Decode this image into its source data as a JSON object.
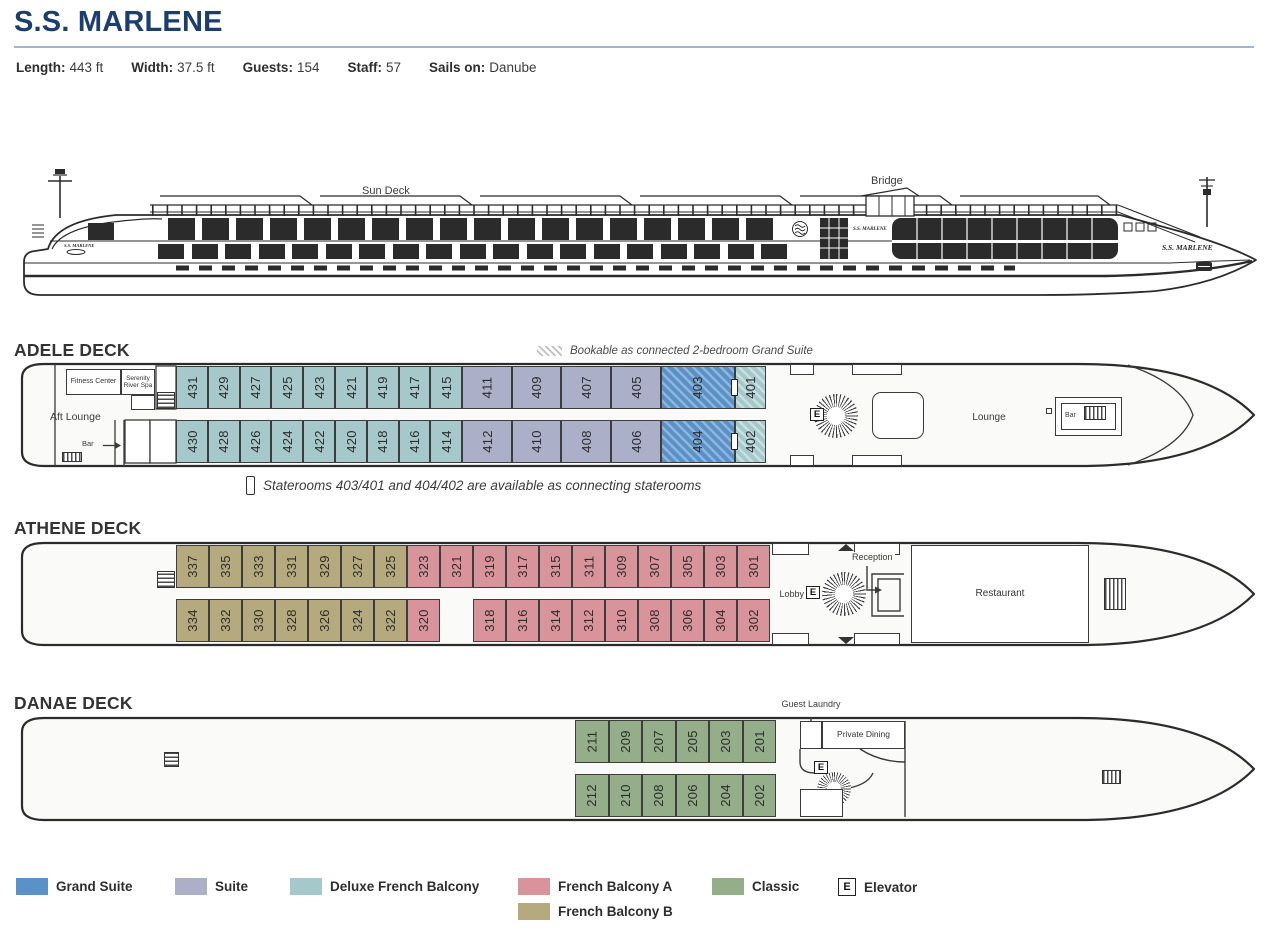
{
  "header": {
    "title": "S.S. MARLENE",
    "stats": [
      {
        "label": "Length:",
        "value": "443 ft"
      },
      {
        "label": "Width:",
        "value": "37.5 ft"
      },
      {
        "label": "Guests:",
        "value": "154"
      },
      {
        "label": "Staff:",
        "value": "57"
      },
      {
        "label": "Sails on:",
        "value": "Danube"
      }
    ]
  },
  "profile": {
    "sun_deck": "Sun Deck",
    "bridge": "Bridge",
    "ship_name": "S.S. MARLENE"
  },
  "decks": {
    "adele": {
      "heading": "ADELE DECK",
      "hatch_note": "Bookable as connected 2-bedroom Grand Suite",
      "connect_note": "Staterooms 403/401 and 404/402 are available as connecting staterooms",
      "features": {
        "fitness": "Fitness Center",
        "spa": "Serenity River Spa",
        "aft_lounge": "Aft Lounge",
        "bar_aft": "Bar",
        "lounge": "Lounge",
        "bar_fwd": "Bar",
        "elevator": "E"
      },
      "rooms_top": [
        {
          "n": "431",
          "cat": "dfb"
        },
        {
          "n": "429",
          "cat": "dfb"
        },
        {
          "n": "427",
          "cat": "dfb"
        },
        {
          "n": "425",
          "cat": "dfb"
        },
        {
          "n": "423",
          "cat": "dfb"
        },
        {
          "n": "421",
          "cat": "dfb"
        },
        {
          "n": "419",
          "cat": "dfb"
        },
        {
          "n": "417",
          "cat": "dfb"
        },
        {
          "n": "415",
          "cat": "dfb"
        },
        {
          "n": "411",
          "cat": "suite"
        },
        {
          "n": "409",
          "cat": "suite"
        },
        {
          "n": "407",
          "cat": "suite"
        },
        {
          "n": "405",
          "cat": "suite"
        },
        {
          "n": "403",
          "cat": "gs",
          "hatch": true
        },
        {
          "n": "401",
          "cat": "dfb",
          "hatch": true,
          "door": true
        }
      ],
      "rooms_bottom": [
        {
          "n": "430",
          "cat": "dfb"
        },
        {
          "n": "428",
          "cat": "dfb"
        },
        {
          "n": "426",
          "cat": "dfb"
        },
        {
          "n": "424",
          "cat": "dfb"
        },
        {
          "n": "422",
          "cat": "dfb"
        },
        {
          "n": "420",
          "cat": "dfb"
        },
        {
          "n": "418",
          "cat": "dfb"
        },
        {
          "n": "416",
          "cat": "dfb"
        },
        {
          "n": "414",
          "cat": "dfb"
        },
        {
          "n": "412",
          "cat": "suite"
        },
        {
          "n": "410",
          "cat": "suite"
        },
        {
          "n": "408",
          "cat": "suite"
        },
        {
          "n": "406",
          "cat": "suite"
        },
        {
          "n": "404",
          "cat": "gs",
          "hatch": true
        },
        {
          "n": "402",
          "cat": "dfb",
          "hatch": true,
          "door": true
        }
      ]
    },
    "athene": {
      "heading": "ATHENE DECK",
      "features": {
        "lobby": "Lobby",
        "reception": "Reception",
        "restaurant": "Restaurant",
        "elevator": "E"
      },
      "rooms_top": [
        {
          "n": "337",
          "cat": "fbb"
        },
        {
          "n": "335",
          "cat": "fbb"
        },
        {
          "n": "333",
          "cat": "fbb"
        },
        {
          "n": "331",
          "cat": "fbb"
        },
        {
          "n": "329",
          "cat": "fbb"
        },
        {
          "n": "327",
          "cat": "fbb"
        },
        {
          "n": "325",
          "cat": "fbb"
        },
        {
          "n": "323",
          "cat": "fba"
        },
        {
          "n": "321",
          "cat": "fba"
        },
        {
          "n": "319",
          "cat": "fba"
        },
        {
          "n": "317",
          "cat": "fba"
        },
        {
          "n": "315",
          "cat": "fba"
        },
        {
          "n": "311",
          "cat": "fba"
        },
        {
          "n": "309",
          "cat": "fba"
        },
        {
          "n": "307",
          "cat": "fba"
        },
        {
          "n": "305",
          "cat": "fba"
        },
        {
          "n": "303",
          "cat": "fba"
        },
        {
          "n": "301",
          "cat": "fba"
        }
      ],
      "rooms_bottom": [
        {
          "n": "334",
          "cat": "fbb"
        },
        {
          "n": "332",
          "cat": "fbb"
        },
        {
          "n": "330",
          "cat": "fbb"
        },
        {
          "n": "328",
          "cat": "fbb"
        },
        {
          "n": "326",
          "cat": "fbb"
        },
        {
          "n": "324",
          "cat": "fbb"
        },
        {
          "n": "322",
          "cat": "fbb"
        },
        {
          "n": "320",
          "cat": "fba"
        },
        {
          "gap": true
        },
        {
          "n": "318",
          "cat": "fba"
        },
        {
          "n": "316",
          "cat": "fba"
        },
        {
          "n": "314",
          "cat": "fba"
        },
        {
          "n": "312",
          "cat": "fba"
        },
        {
          "n": "310",
          "cat": "fba"
        },
        {
          "n": "308",
          "cat": "fba"
        },
        {
          "n": "306",
          "cat": "fba"
        },
        {
          "n": "304",
          "cat": "fba"
        },
        {
          "n": "302",
          "cat": "fba"
        }
      ]
    },
    "danae": {
      "heading": "DANAE DECK",
      "features": {
        "guest_laundry": "Guest Laundry",
        "private_dining": "Private Dining",
        "elevator": "E"
      },
      "rooms_top": [
        {
          "n": "211",
          "cat": "classic"
        },
        {
          "n": "209",
          "cat": "classic"
        },
        {
          "n": "207",
          "cat": "classic"
        },
        {
          "n": "205",
          "cat": "classic"
        },
        {
          "n": "203",
          "cat": "classic"
        },
        {
          "n": "201",
          "cat": "classic"
        }
      ],
      "rooms_bottom": [
        {
          "n": "212",
          "cat": "classic"
        },
        {
          "n": "210",
          "cat": "classic"
        },
        {
          "n": "208",
          "cat": "classic"
        },
        {
          "n": "206",
          "cat": "classic"
        },
        {
          "n": "204",
          "cat": "classic"
        },
        {
          "n": "202",
          "cat": "classic"
        }
      ]
    }
  },
  "legend": {
    "items": [
      {
        "label": "Grand Suite",
        "cat": "gs"
      },
      {
        "label": "Suite",
        "cat": "suite"
      },
      {
        "label": "Deluxe French Balcony",
        "cat": "dfb"
      },
      {
        "label": "French Balcony A",
        "cat": "fba"
      },
      {
        "label": "Classic",
        "cat": "classic"
      }
    ],
    "row2": {
      "label": "French Balcony B",
      "cat": "fbb"
    },
    "elevator": {
      "symbol": "E",
      "label": "Elevator"
    }
  },
  "colors": {
    "gs": "#5a92c8",
    "gs_light": "#8fb5dc",
    "suite": "#abafc7",
    "dfb": "#a5c8cb",
    "dfb_light": "#c9e0e1",
    "fba": "#d9939b",
    "fbb": "#b5aa7d",
    "classic": "#93ae88"
  }
}
